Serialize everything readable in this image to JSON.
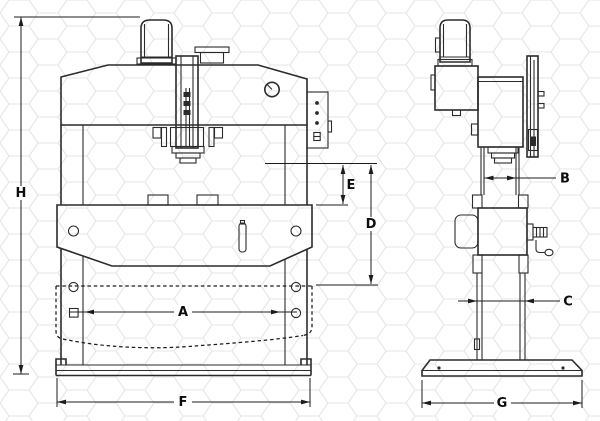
{
  "labels": {
    "A": "A",
    "B": "B",
    "C": "C",
    "D": "D",
    "E": "E",
    "F": "F",
    "G": "G",
    "H": "H"
  },
  "colors": {
    "bg": "#ffffff",
    "line": "#2b2b2b",
    "dim_line": "#1c1c1c",
    "hex_pattern": "#e6e6e6"
  }
}
